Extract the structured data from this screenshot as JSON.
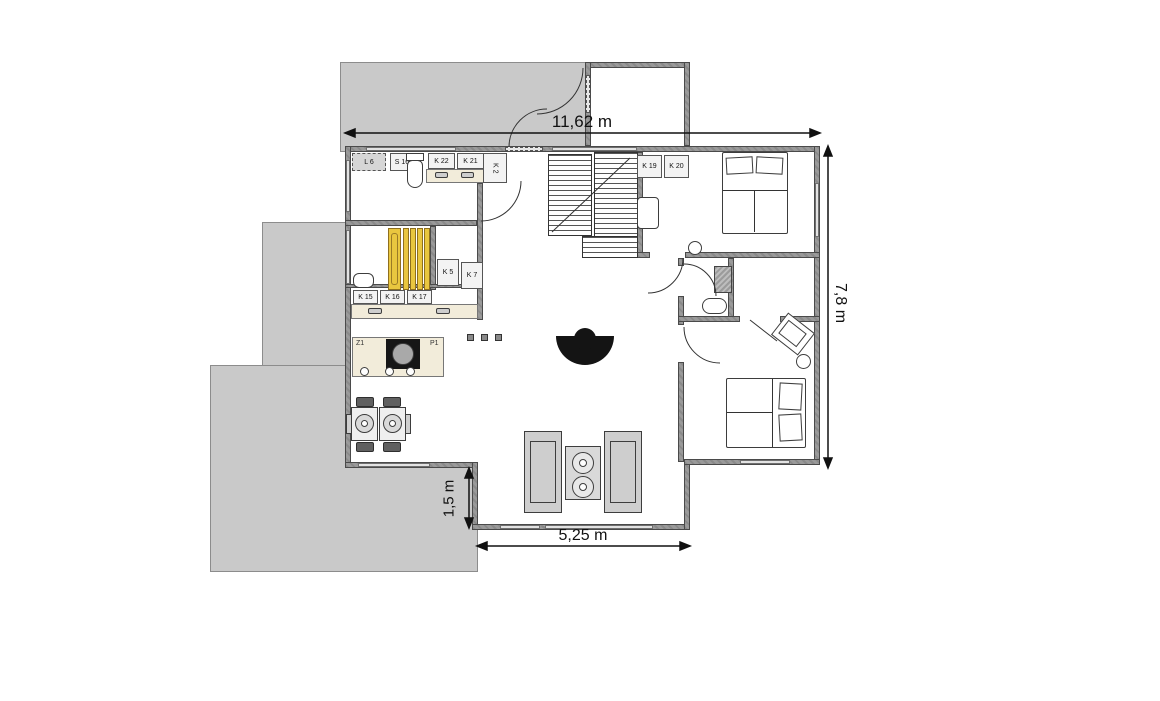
{
  "page": {
    "title": "Floor plan"
  },
  "dimensions": {
    "top": "11,62 m",
    "right": "7,8 m",
    "bottom": "5,25 m",
    "left_offset": "1,5 m"
  },
  "cabinet_labels": {
    "l6": "L 6",
    "s16": "S 16",
    "k22": "K 22",
    "k21": "K 21",
    "k2": "K 2",
    "k5": "K 5",
    "k7": "K 7",
    "k15": "K 15",
    "k16": "K 16",
    "k17": "K 17",
    "k19": "K 19",
    "k20": "K 20"
  },
  "island_labels": {
    "left": "Z1",
    "right": "P1"
  },
  "colors": {
    "deck": "#c9c9c9",
    "wall": "#9a9a9a",
    "sauna_bench": "#e9c63f",
    "counter": "#f2ecda",
    "furniture": "#cecece",
    "fireplace": "#141414"
  }
}
